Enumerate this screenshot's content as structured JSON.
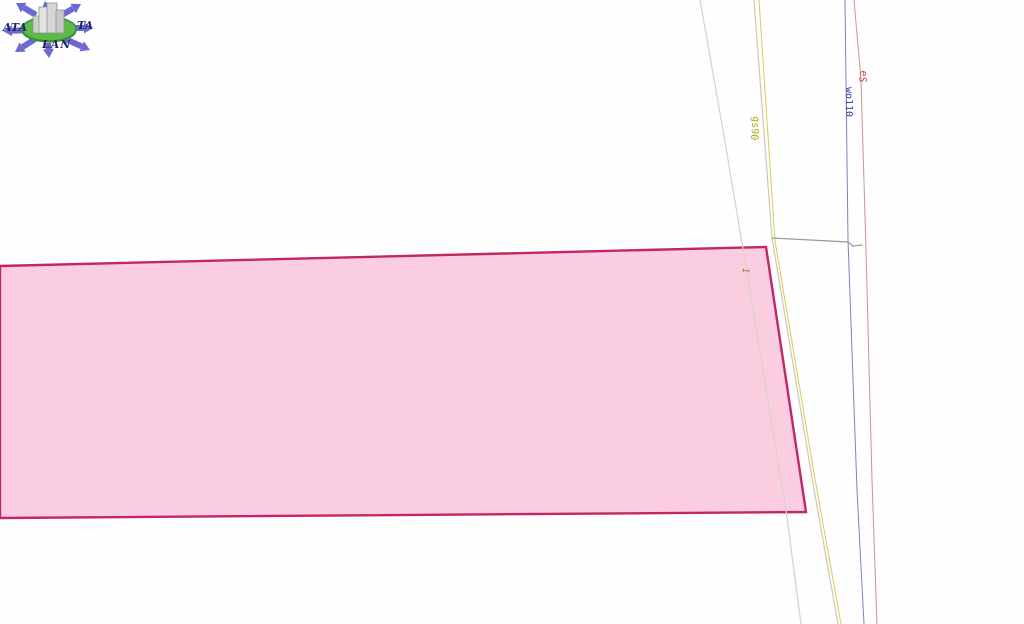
{
  "app": {
    "title": "Cadastral parcel map view"
  },
  "logo": {
    "text_left": "ATA",
    "text_right": "TA",
    "text_bottom": "LAN",
    "arrow_color": "#6a6ad2",
    "ellipse_fill": "#5eba4a",
    "ellipse_stroke": "#35923a",
    "building_fill": "#d9d9d9",
    "building_stroke": "#8a8a8a",
    "text_color": "#232366"
  },
  "map": {
    "background": "#fefefe",
    "parcel": {
      "points": "0,266 766,247 806,512 0,518",
      "fill": "#f9c8de",
      "stroke": "#c12766",
      "stroke_width": 2.4
    },
    "lines": [
      {
        "name": "road-left-edge-line",
        "color": "#d9d2bd",
        "width": 1.2,
        "points": [
          [
            700,
            0
          ],
          [
            723,
            130
          ],
          [
            744,
            255
          ],
          [
            786,
            510
          ],
          [
            801,
            624
          ]
        ]
      },
      {
        "name": "road-right-edge-line",
        "color": "#cdc7b4",
        "width": 1.2,
        "points": [
          [
            754,
            0
          ],
          [
            772,
            238
          ],
          [
            812,
            478
          ],
          [
            838,
            624
          ]
        ]
      },
      {
        "name": "gas-pipeline-line",
        "color": "#d8cd55",
        "width": 1.0,
        "points": [
          [
            759,
            0
          ],
          [
            775,
            241
          ],
          [
            815,
            479
          ],
          [
            841,
            624
          ]
        ]
      },
      {
        "name": "water-pipeline-line",
        "color": "#8080b8",
        "width": 1.0,
        "points": [
          [
            845,
            0
          ],
          [
            848,
            240
          ],
          [
            857,
            490
          ],
          [
            864,
            624
          ]
        ]
      },
      {
        "name": "power-line-line",
        "color": "#c99595",
        "width": 1.0,
        "points": [
          [
            854,
            0
          ],
          [
            861,
            80
          ],
          [
            866,
            250
          ],
          [
            872,
            480
          ],
          [
            877,
            624
          ]
        ]
      },
      {
        "name": "boundary-connector-line",
        "color": "#9a9a9a",
        "width": 1.3,
        "points": [
          [
            772,
            238
          ],
          [
            848,
            242
          ],
          [
            853,
            246
          ],
          [
            862,
            245
          ]
        ]
      }
    ],
    "labels": [
      {
        "name": "gas-pipeline-label",
        "text": "gs90",
        "x": 752,
        "y": 128,
        "rotate": 95,
        "color": "#b0a61a",
        "size": 10
      },
      {
        "name": "water-pipeline-label",
        "text": "wo110",
        "x": 846,
        "y": 102,
        "rotate": 90,
        "color": "#3b3b9e",
        "size": 10
      },
      {
        "name": "power-line-label",
        "text": "eS",
        "x": 860,
        "y": 76,
        "rotate": 100,
        "color": "#c0483a",
        "size": 10
      },
      {
        "name": "parcel-point-label",
        "text": "1",
        "x": 743,
        "y": 270,
        "rotate": 99,
        "color": "#a56a28",
        "size": 9
      }
    ]
  }
}
